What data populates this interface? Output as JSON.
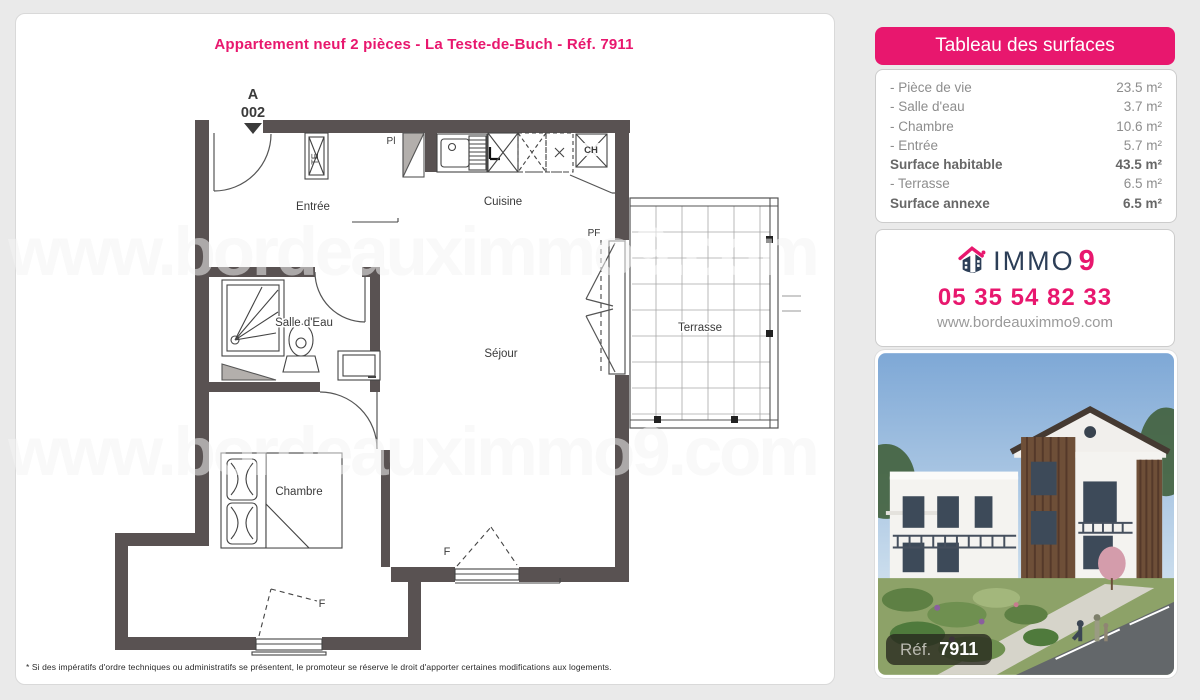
{
  "page": {
    "title": "Appartement neuf 2 pièces - La Teste-de-Buch - Réf. 7911",
    "watermark": "www.bordeauximmo9.com",
    "footnote": "* Si des impératifs d'ordre techniques ou administratifs se présentent, le promoteur se réserve le droit d'apporter certaines modifications aux logements."
  },
  "plan": {
    "unit_letter": "A",
    "unit_number": "002",
    "labels": {
      "entree": "Entrée",
      "cuisine": "Cuisine",
      "salle_eau": "Salle d'Eau",
      "sejour": "Séjour",
      "chambre": "Chambre",
      "terrasse": "Terrasse",
      "pf": "PF",
      "pl": "Pl",
      "te": "TE",
      "ch": "CH",
      "f1": "F",
      "f2": "F"
    }
  },
  "surfaces": {
    "header": "Tableau des surfaces",
    "rows": [
      {
        "label": "- Pièce de vie",
        "value": "23.5 m²"
      },
      {
        "label": "- Salle d'eau",
        "value": "3.7 m²"
      },
      {
        "label": "- Chambre",
        "value": "10.6 m²"
      },
      {
        "label": "- Entrée",
        "value": "5.7 m²"
      },
      {
        "label": "Surface habitable",
        "value": "43.5 m²"
      },
      {
        "label": "- Terrasse",
        "value": "6.5 m²"
      },
      {
        "label": "Surface annexe",
        "value": "6.5 m²"
      }
    ]
  },
  "contact": {
    "brand": "IMMO",
    "brand_digit": "9",
    "phone": "05 35 54 82 33",
    "website": "www.bordeauximmo9.com"
  },
  "photo": {
    "ref_label": "Réf.",
    "ref_value": "7911"
  },
  "colors": {
    "accent_pink": "#e8176e",
    "wall": "#595252",
    "navy": "#2c3e57"
  }
}
